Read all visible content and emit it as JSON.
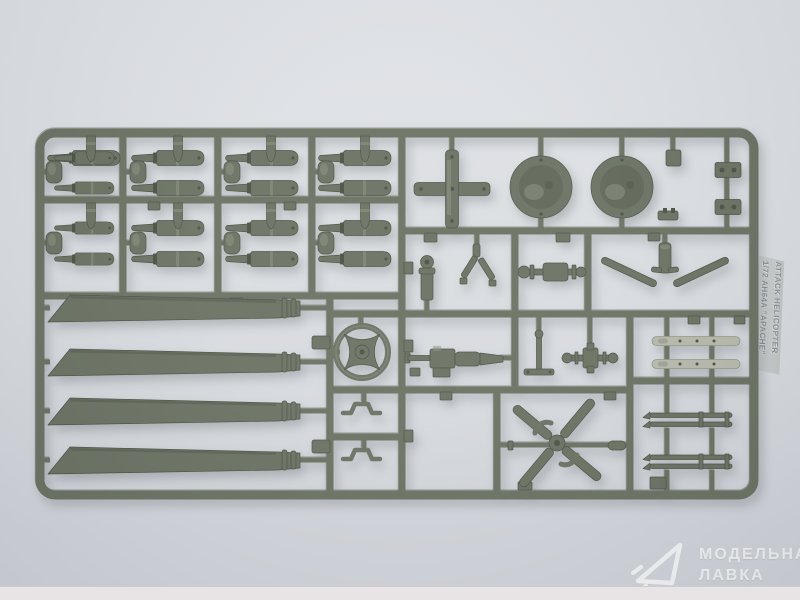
{
  "scene": {
    "description": "Top-down product photo of an olive-drab injection-molded styrene sprue (parts frame) for a 1/72 scale AH-64A Apache attack helicopter model kit, lying on a light gray surface",
    "type": "product-photo"
  },
  "colors": {
    "bg-top": "#dee1e5",
    "bg-mid": "#d8dbdf",
    "bg-bottom": "#cfd2d8",
    "bg-strip": "#e8e4e5",
    "sprue": "#626a5a",
    "sprue-light": "#838b78",
    "sprue-dark": "#41483a",
    "sprue-mid": "#575e4e",
    "dome-light": "#79816e",
    "part-light": "#b2b6a7",
    "tag-bg": "#c9cecd",
    "tag-text": "#828a8c",
    "watermark": "#ffffff"
  },
  "tag": {
    "line1": "1/72 AH64A \"APACHE\"",
    "line2": "ATTACK HELICOPTER"
  },
  "watermark": {
    "line1": "МОДЕЛЬНАЯ",
    "line2": "ЛАВКА"
  },
  "sprue_parts": {
    "missile_halves_large": 12,
    "missile_halves_small": 4,
    "warhead_tips": 8,
    "rotor_blades": 4,
    "dome_covers": 2,
    "cross_frame": 1,
    "rotor_hub_ring": 1,
    "chain_gun": 1,
    "tail_rotor": 1,
    "landing_gear_legs": 2,
    "launch_rails": 2,
    "rod_parts": 4,
    "small_brackets": 2
  }
}
